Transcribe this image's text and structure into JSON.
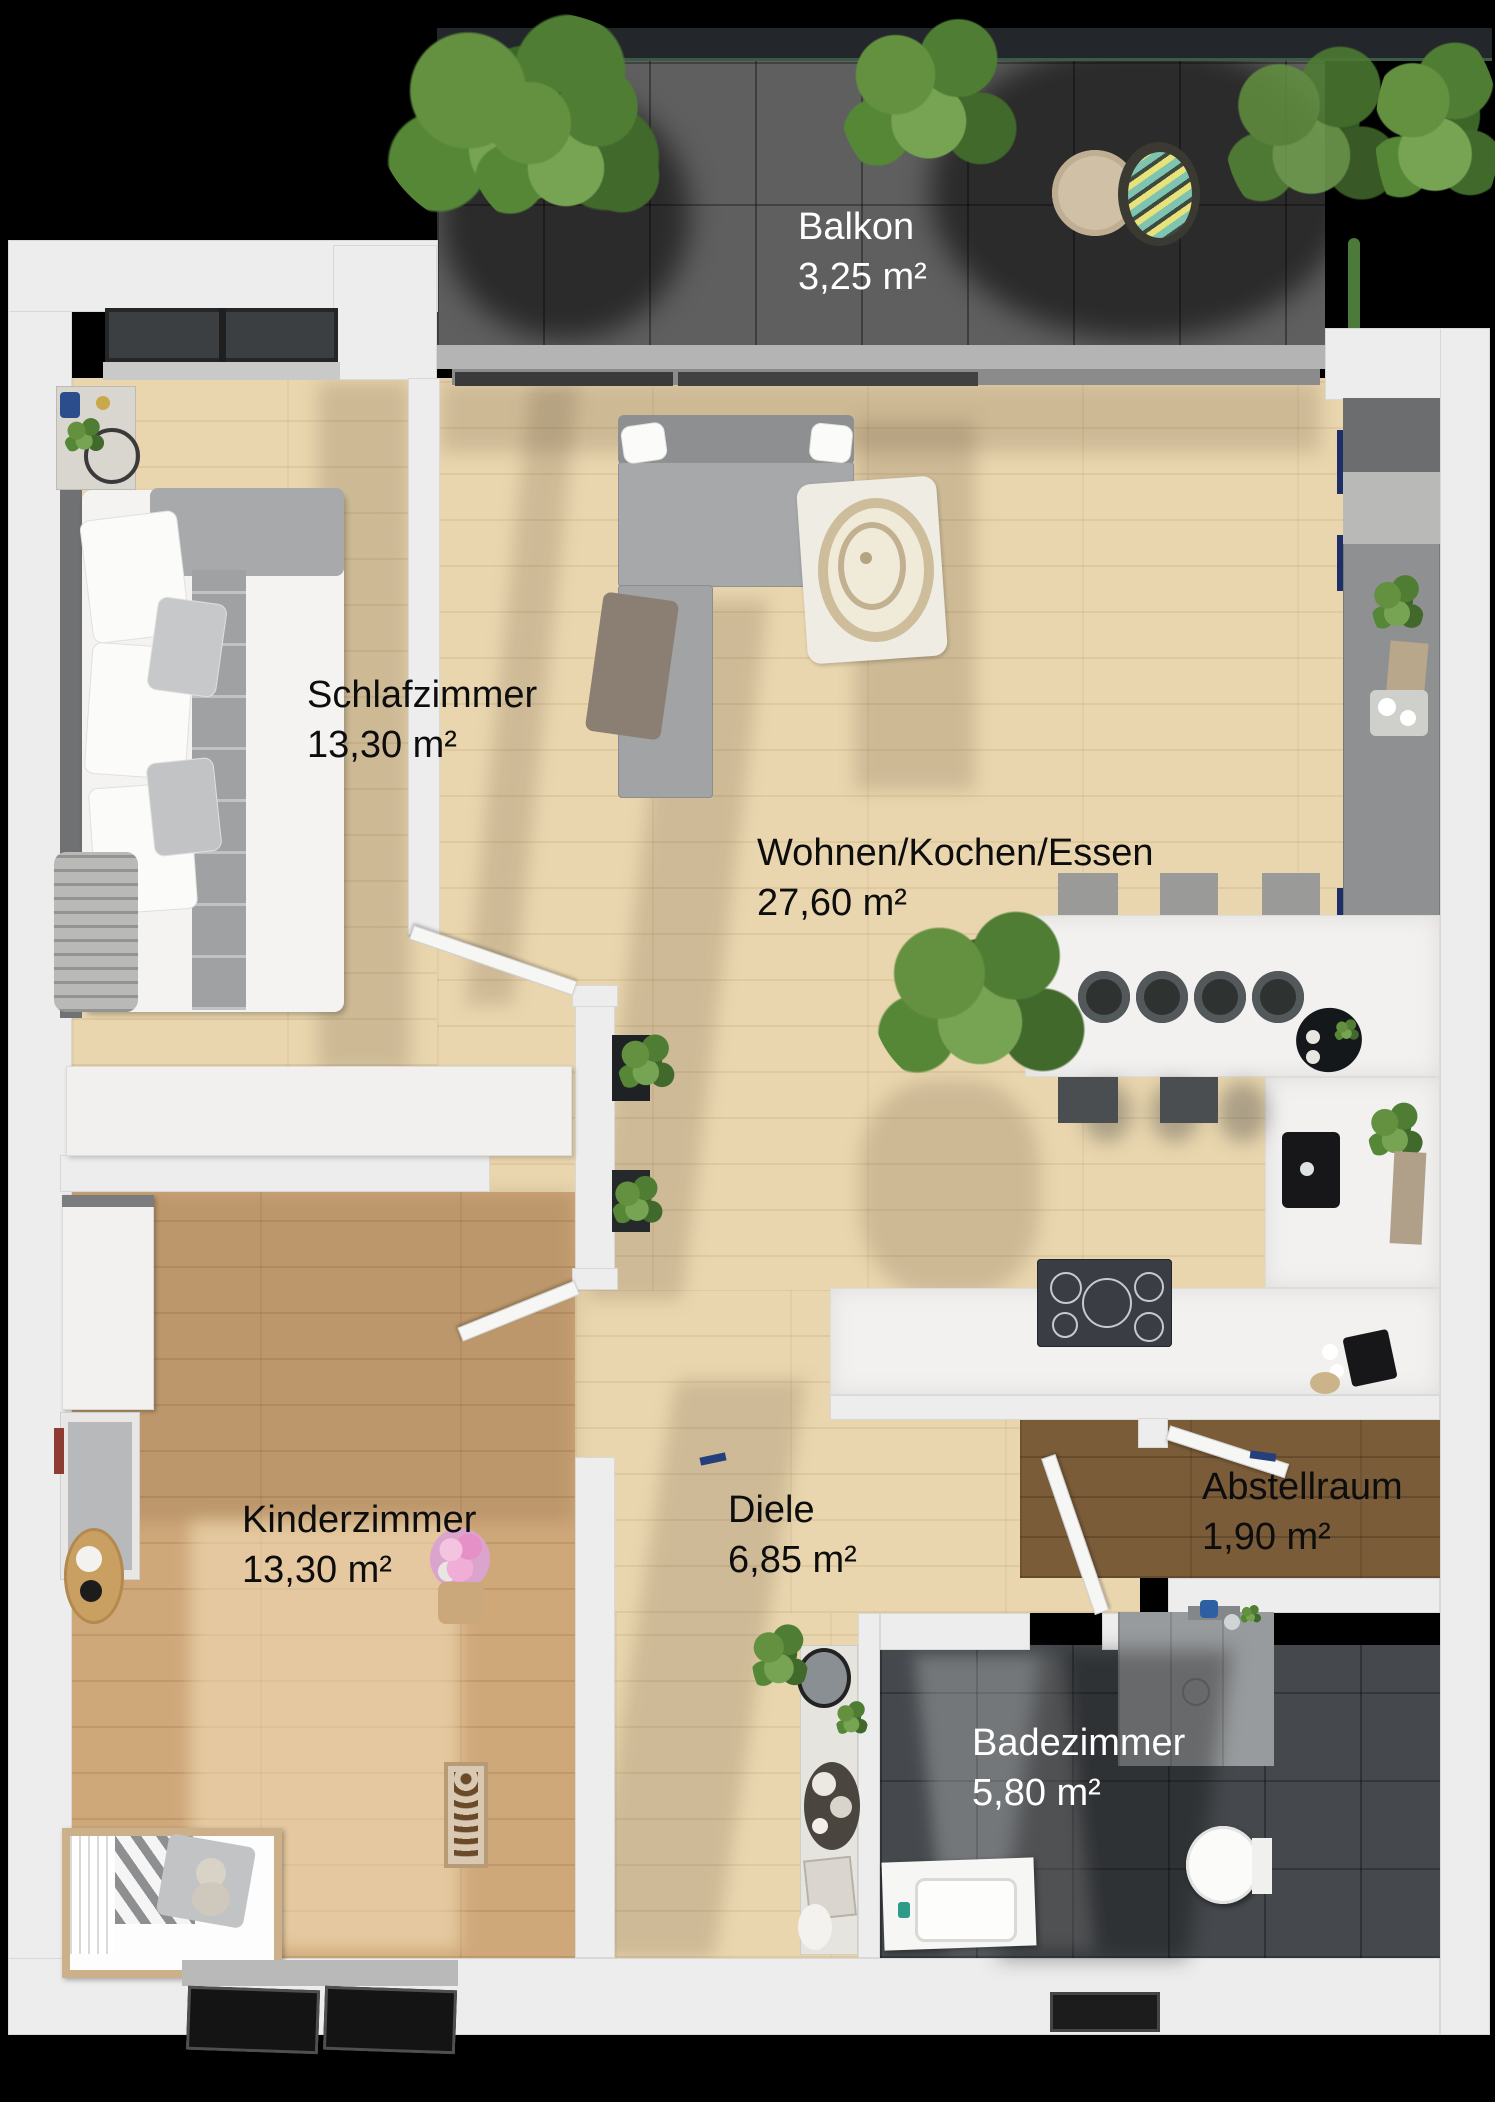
{
  "plan": {
    "title": "Apartment floor plan",
    "balcony": {
      "name": "Balkon",
      "area": "3,25 m²"
    },
    "rooms": [
      {
        "id": "schlafzimmer",
        "name": "Schlafzimmer",
        "area": "13,30 m²",
        "label_color": "#0d0d0d"
      },
      {
        "id": "wohnen-kochen-essen",
        "name": "Wohnen/Kochen/Essen",
        "area": "27,60 m²",
        "label_color": "#0d0d0d"
      },
      {
        "id": "kinderzimmer",
        "name": "Kinderzimmer",
        "area": "13,30 m²",
        "label_color": "#0d0d0d"
      },
      {
        "id": "diele",
        "name": "Diele",
        "area": "6,85 m²",
        "label_color": "#0d0d0d"
      },
      {
        "id": "abstellraum",
        "name": "Abstellraum",
        "area": "1,90 m²",
        "label_color": "#0d0d0d"
      },
      {
        "id": "badezimmer",
        "name": "Badezimmer",
        "area": "5,80 m²",
        "label_color": "#ffffff"
      }
    ],
    "colors": {
      "background": "#000000",
      "wall": "#ededed",
      "wood_light": "#e9d6ae",
      "wood_medium": "#cfa87a",
      "wood_dark": "#7b5c39",
      "bath_tile": "#45494d",
      "balcony_tile": "#5f5f5f",
      "marble": "#f2f1ef",
      "counter_concrete": "#8f9092",
      "plant_green": "#5d8f46"
    }
  }
}
